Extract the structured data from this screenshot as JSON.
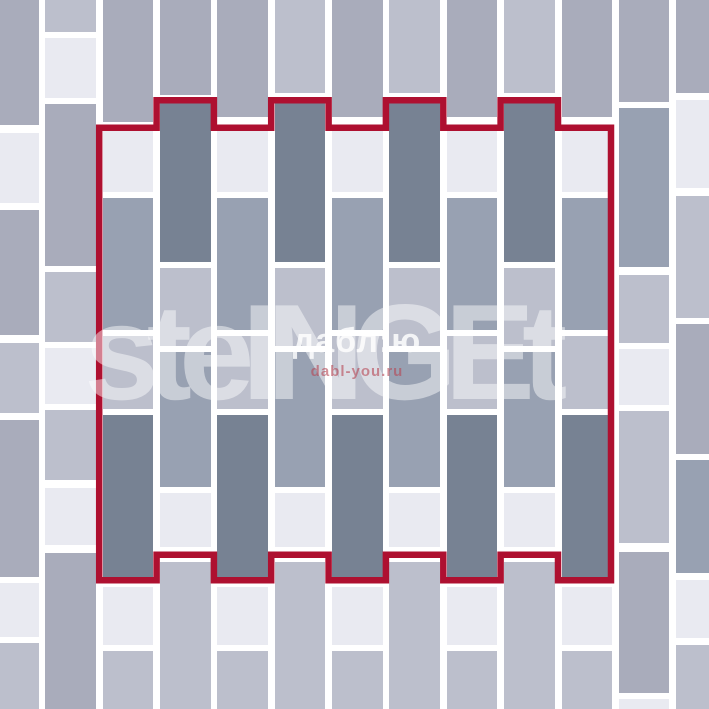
{
  "canvas": {
    "width": 709,
    "height": 709
  },
  "description": "Paving brick laying scheme: vertical running-bond multiformat pattern with red outline marking the repeating unit",
  "colors": {
    "D": "#778293",
    "B": "#98a1b2",
    "M": "#a9acbb",
    "C": "#bcbfcc",
    "W": "#e9eaf1",
    "joint": "#ffffff",
    "outline": "#ae1030"
  },
  "color_legend": {
    "D": "dark-slate-brick",
    "B": "blue-gray-brick",
    "M": "medium-lavender-brick",
    "C": "light-lavender-brick",
    "W": "off-white-brick"
  },
  "watermarks": {
    "brand": "steINGEt",
    "site_title": "дабл:ю",
    "site_url": "dabl-you.ru"
  },
  "outline": {
    "color": "#ae1030",
    "stroke_width": 6.5,
    "path": "M 99.2 127.75 H 156.6 V 100.25 H 213.9 V 127.75 H 271.2 V 100.25 H 328.6 V 127.75 H 385.9 V 100.25 H 443.3 V 127.75 H 500.6 V 100.25 H 558 V 127.75 H 611 V 580.25 H 558 V 554.75 H 500.6 V 580.25 H 443.3 V 554.75 H 385.9 V 580.25 H 328.6 V 554.75 H 271.2 V 580.25 H 213.9 V 554.75 H 156.6 V 580.25 H 99.2 Z",
    "top_tab_columns": [
      3,
      5,
      7,
      9
    ],
    "bottom_tab_columns": [
      2,
      4,
      6,
      8,
      10
    ]
  },
  "columns": [
    {
      "x": 0,
      "w": 38.5,
      "bricks": [
        [
          0,
          125,
          "M"
        ],
        [
          133,
          203,
          "W"
        ],
        [
          210,
          335,
          "M"
        ],
        [
          343,
          413,
          "C"
        ],
        [
          420,
          577,
          "M"
        ],
        [
          583,
          637,
          "W"
        ],
        [
          643,
          709,
          "C"
        ]
      ]
    },
    {
      "x": 45.3,
      "w": 50.5,
      "bricks": [
        [
          0,
          32,
          "C"
        ],
        [
          38,
          98,
          "W"
        ],
        [
          104,
          266,
          "M"
        ],
        [
          272,
          342,
          "C"
        ],
        [
          348,
          404,
          "W"
        ],
        [
          410,
          480,
          "C"
        ],
        [
          488,
          545,
          "W"
        ],
        [
          553,
          709,
          "M"
        ]
      ]
    },
    {
      "x": 102.7,
      "w": 50.5,
      "bricks": [
        [
          0,
          122,
          "M"
        ],
        [
          131,
          192,
          "W"
        ],
        [
          198,
          330,
          "B"
        ],
        [
          336,
          409,
          "C"
        ],
        [
          415,
          577,
          "D"
        ],
        [
          587,
          645,
          "W"
        ],
        [
          651,
          709,
          "C"
        ]
      ]
    },
    {
      "x": 160.0,
      "w": 50.5,
      "bricks": [
        [
          0,
          95,
          "M"
        ],
        [
          103,
          262,
          "D"
        ],
        [
          268,
          346,
          "C"
        ],
        [
          352,
          487,
          "B"
        ],
        [
          493,
          547,
          "W"
        ],
        [
          562,
          709,
          "C"
        ]
      ]
    },
    {
      "x": 217.4,
      "w": 50.5,
      "bricks": [
        [
          0,
          117,
          "M"
        ],
        [
          131,
          192,
          "W"
        ],
        [
          198,
          330,
          "B"
        ],
        [
          336,
          409,
          "C"
        ],
        [
          415,
          577,
          "D"
        ],
        [
          587,
          645,
          "W"
        ],
        [
          651,
          709,
          "C"
        ]
      ]
    },
    {
      "x": 274.7,
      "w": 50.5,
      "bricks": [
        [
          0,
          93,
          "C"
        ],
        [
          103,
          262,
          "D"
        ],
        [
          268,
          346,
          "C"
        ],
        [
          352,
          487,
          "B"
        ],
        [
          493,
          547,
          "W"
        ],
        [
          562,
          709,
          "C"
        ]
      ]
    },
    {
      "x": 332.1,
      "w": 50.5,
      "bricks": [
        [
          0,
          117,
          "M"
        ],
        [
          131,
          192,
          "W"
        ],
        [
          198,
          330,
          "B"
        ],
        [
          336,
          409,
          "C"
        ],
        [
          415,
          577,
          "D"
        ],
        [
          587,
          645,
          "W"
        ],
        [
          651,
          709,
          "C"
        ]
      ]
    },
    {
      "x": 389.4,
      "w": 50.5,
      "bricks": [
        [
          0,
          93,
          "C"
        ],
        [
          103,
          262,
          "D"
        ],
        [
          268,
          346,
          "C"
        ],
        [
          352,
          487,
          "B"
        ],
        [
          493,
          547,
          "W"
        ],
        [
          562,
          709,
          "C"
        ]
      ]
    },
    {
      "x": 446.8,
      "w": 50.5,
      "bricks": [
        [
          0,
          117,
          "M"
        ],
        [
          131,
          192,
          "W"
        ],
        [
          198,
          330,
          "B"
        ],
        [
          336,
          409,
          "C"
        ],
        [
          415,
          577,
          "D"
        ],
        [
          587,
          645,
          "W"
        ],
        [
          651,
          709,
          "C"
        ]
      ]
    },
    {
      "x": 504.1,
      "w": 50.5,
      "bricks": [
        [
          0,
          93,
          "C"
        ],
        [
          103,
          262,
          "D"
        ],
        [
          268,
          346,
          "C"
        ],
        [
          352,
          487,
          "B"
        ],
        [
          493,
          547,
          "W"
        ],
        [
          562,
          709,
          "C"
        ]
      ]
    },
    {
      "x": 561.5,
      "w": 50.5,
      "bricks": [
        [
          0,
          117,
          "M"
        ],
        [
          131,
          192,
          "W"
        ],
        [
          198,
          330,
          "B"
        ],
        [
          336,
          409,
          "C"
        ],
        [
          415,
          577,
          "D"
        ],
        [
          587,
          645,
          "W"
        ],
        [
          651,
          709,
          "C"
        ]
      ]
    },
    {
      "x": 618.8,
      "w": 50.5,
      "bricks": [
        [
          0,
          102,
          "M"
        ],
        [
          108,
          267,
          "B"
        ],
        [
          275,
          343,
          "C"
        ],
        [
          349,
          405,
          "W"
        ],
        [
          411,
          543,
          "C"
        ],
        [
          552,
          693,
          "M"
        ],
        [
          699,
          709,
          "W"
        ]
      ]
    },
    {
      "x": 676.2,
      "w": 32.8,
      "bricks": [
        [
          0,
          93,
          "M"
        ],
        [
          100,
          188,
          "W"
        ],
        [
          196,
          318,
          "C"
        ],
        [
          324,
          454,
          "M"
        ],
        [
          460,
          573,
          "B"
        ],
        [
          580,
          638,
          "W"
        ],
        [
          645,
          709,
          "C"
        ]
      ]
    }
  ]
}
